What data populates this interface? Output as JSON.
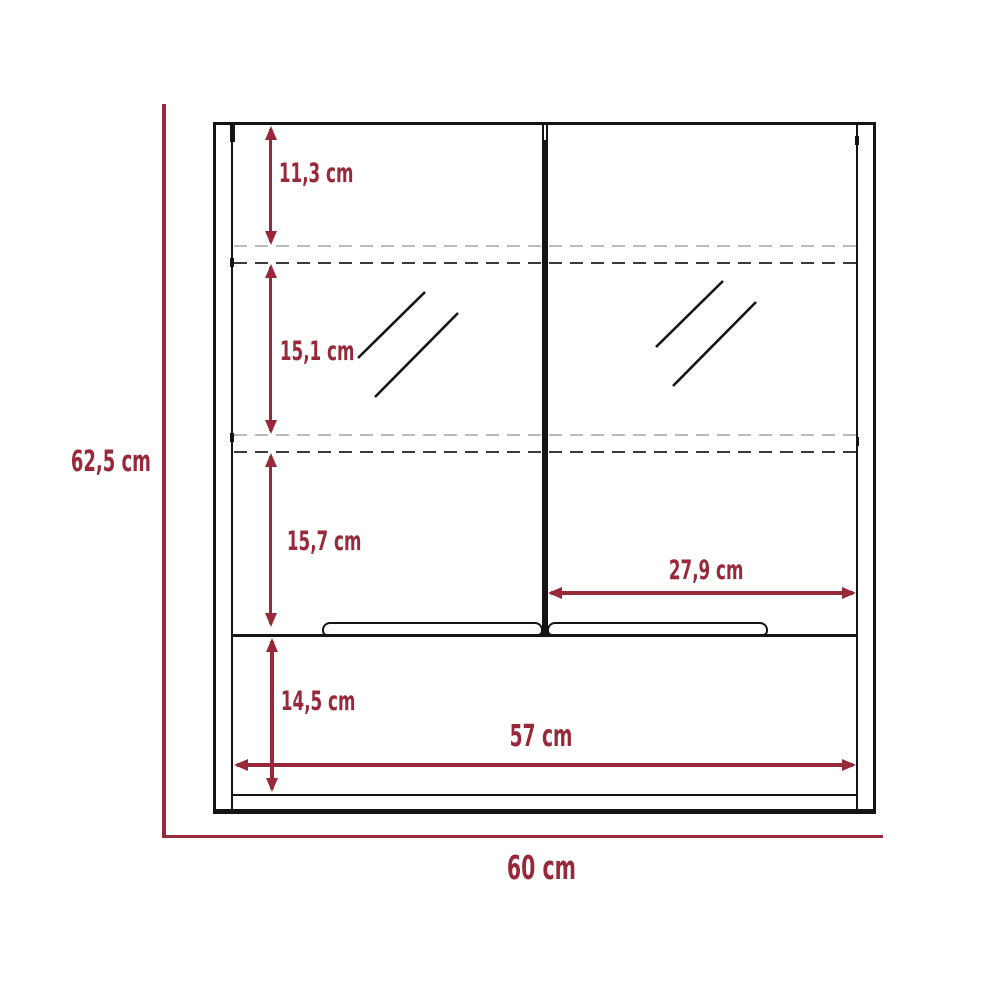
{
  "diagram": {
    "subject": "Mirror cabinet with two doors - dimensioned front view",
    "unit": "cm",
    "colors": {
      "dimension": "#97293a",
      "outline": "#141414",
      "dashed_shelf_light": "#b7bcc1",
      "dashed_shelf_dark": "#3a3a3a",
      "background": "#ffffff"
    },
    "labels": {
      "overall_height": "62,5 cm",
      "overall_width": "60 cm",
      "top_section": "11,3 cm",
      "mirror_section": "15,1 cm",
      "lower_section": "15,7 cm",
      "base_section": "14,5 cm",
      "door_width": "27,9 cm",
      "inner_width": "57 cm"
    }
  }
}
